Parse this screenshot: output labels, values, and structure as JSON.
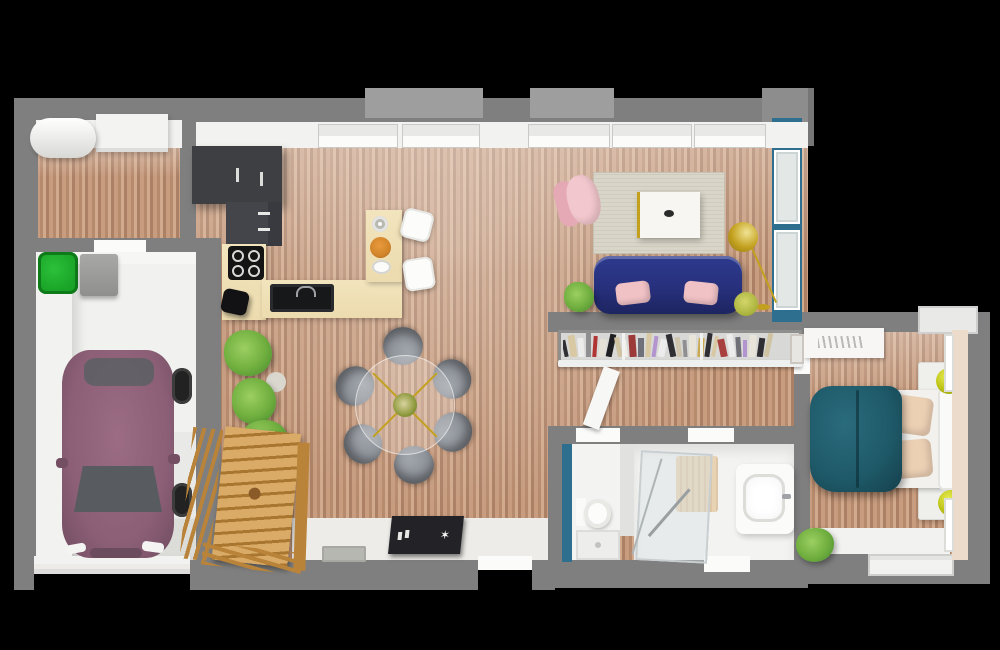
{
  "meta": {
    "type": "3d-floor-plan-render",
    "view": "top-down",
    "background": "#000000"
  },
  "palette": {
    "wall": "#7f7f7f",
    "wallLight": "#9e9e9e",
    "whiteWall": "#f2f2f0",
    "whiteBright": "#fbfbfa",
    "woodA": "#c79c7f",
    "woodB": "#b68a6d",
    "woodC": "#d1a98c",
    "woodD": "#ab8065",
    "garageFloor": "#e9e9e7",
    "bathFloor": "#f3f3f1",
    "entryFloor": "#edece8",
    "blueAccent": "#2e6e8e",
    "navySofa": "#27307c",
    "pinkLight": "#f2c7cd",
    "pinkDark": "#e5a9b6",
    "pinkPillow": "#f0c2c6",
    "tealBed": "#1e5968",
    "tealBedDark": "#16424e",
    "beigePillow": "#ecd0b4",
    "gold": "#c3a11f",
    "chartreuse": "#bcc214",
    "plantGreen": "#6fae3e",
    "plantDark": "#4c8f31",
    "binGreen": "#18a226",
    "carMauve": "#8c5f77",
    "carDark": "#744f63",
    "glassDark": "#585b60",
    "stairWood": "#d9ab66",
    "stairWoodDark": "#b9833a",
    "counterCream": "#ecdbae",
    "cabinetDark": "#3d3f43",
    "rugBeige": "#d9d6c9",
    "chairGray": "#8a8f96",
    "consoleBlack": "#232327",
    "bedroomWall": "#ecdaca",
    "bathMat": "#e8d4b5",
    "matGray": "#b7b7b2",
    "bowlOrange": "#d2842a"
  },
  "rooms": [
    {
      "id": "utility-room",
      "label": "Utility room"
    },
    {
      "id": "garage",
      "label": "Garage"
    },
    {
      "id": "kitchen",
      "label": "Kitchen"
    },
    {
      "id": "dining-area",
      "label": "Dining area"
    },
    {
      "id": "living-room",
      "label": "Living room"
    },
    {
      "id": "hallway",
      "label": "Hallway"
    },
    {
      "id": "wc",
      "label": "WC"
    },
    {
      "id": "bathroom",
      "label": "Bathroom"
    },
    {
      "id": "bedroom",
      "label": "Bedroom"
    },
    {
      "id": "entry",
      "label": "Entry"
    },
    {
      "id": "staircase",
      "label": "Staircase"
    }
  ],
  "furniture": {
    "utility-room": [
      "air-duct",
      "cabinet"
    ],
    "garage": [
      "car",
      "recycling-bin",
      "wall-cabinet",
      "garage-door"
    ],
    "kitchen": [
      "upper-cabinets",
      "oven-column",
      "cooktop",
      "sink",
      "l-shaped-counter",
      "island-counter",
      "bar-stools",
      "fruit-bowl",
      "potted-plants"
    ],
    "dining-area": [
      "round-glass-table",
      "six-chairs",
      "centerpiece"
    ],
    "living-room": [
      "navy-sofa",
      "pink-cushions",
      "marble-coffee-table",
      "pink-armchair",
      "gold-floor-lamp",
      "rug",
      "plants",
      "bookshelf"
    ],
    "wc": [
      "toilet",
      "shower-tray"
    ],
    "bathroom": [
      "walk-in-shower",
      "vanity-sink",
      "bath-mat"
    ],
    "bedroom": [
      "double-bed-teal-duvet",
      "headboard",
      "pillows",
      "two-nightstands",
      "two-lamps",
      "desk",
      "wall-art",
      "plant",
      "white-rug"
    ],
    "entry": [
      "black-console",
      "doormat",
      "front-door"
    ]
  },
  "bookshelf": {
    "books": [
      "#2e2e33",
      "#d8c9a4",
      "#ececec",
      "#8f8f92",
      "#b03434",
      "#e4e0d6",
      "#1f1f23",
      "#cfc3a2",
      "#f0ede6",
      "#9c3a3a",
      "#70707a",
      "#d8c9a4",
      "#b295cf",
      "#ececec",
      "#2e2e33",
      "#cfc5ae",
      "#8f8f92",
      "#e8e4da",
      "#caa84e",
      "#2e2e33",
      "#d8c9a4",
      "#a94040",
      "#ececec",
      "#6f6f78",
      "#b295cf",
      "#e8e4da",
      "#2e2e33",
      "#cfc3a2"
    ]
  },
  "dining": {
    "chair_count": 6
  },
  "decor": {
    "console_star_glyph": "✶"
  }
}
